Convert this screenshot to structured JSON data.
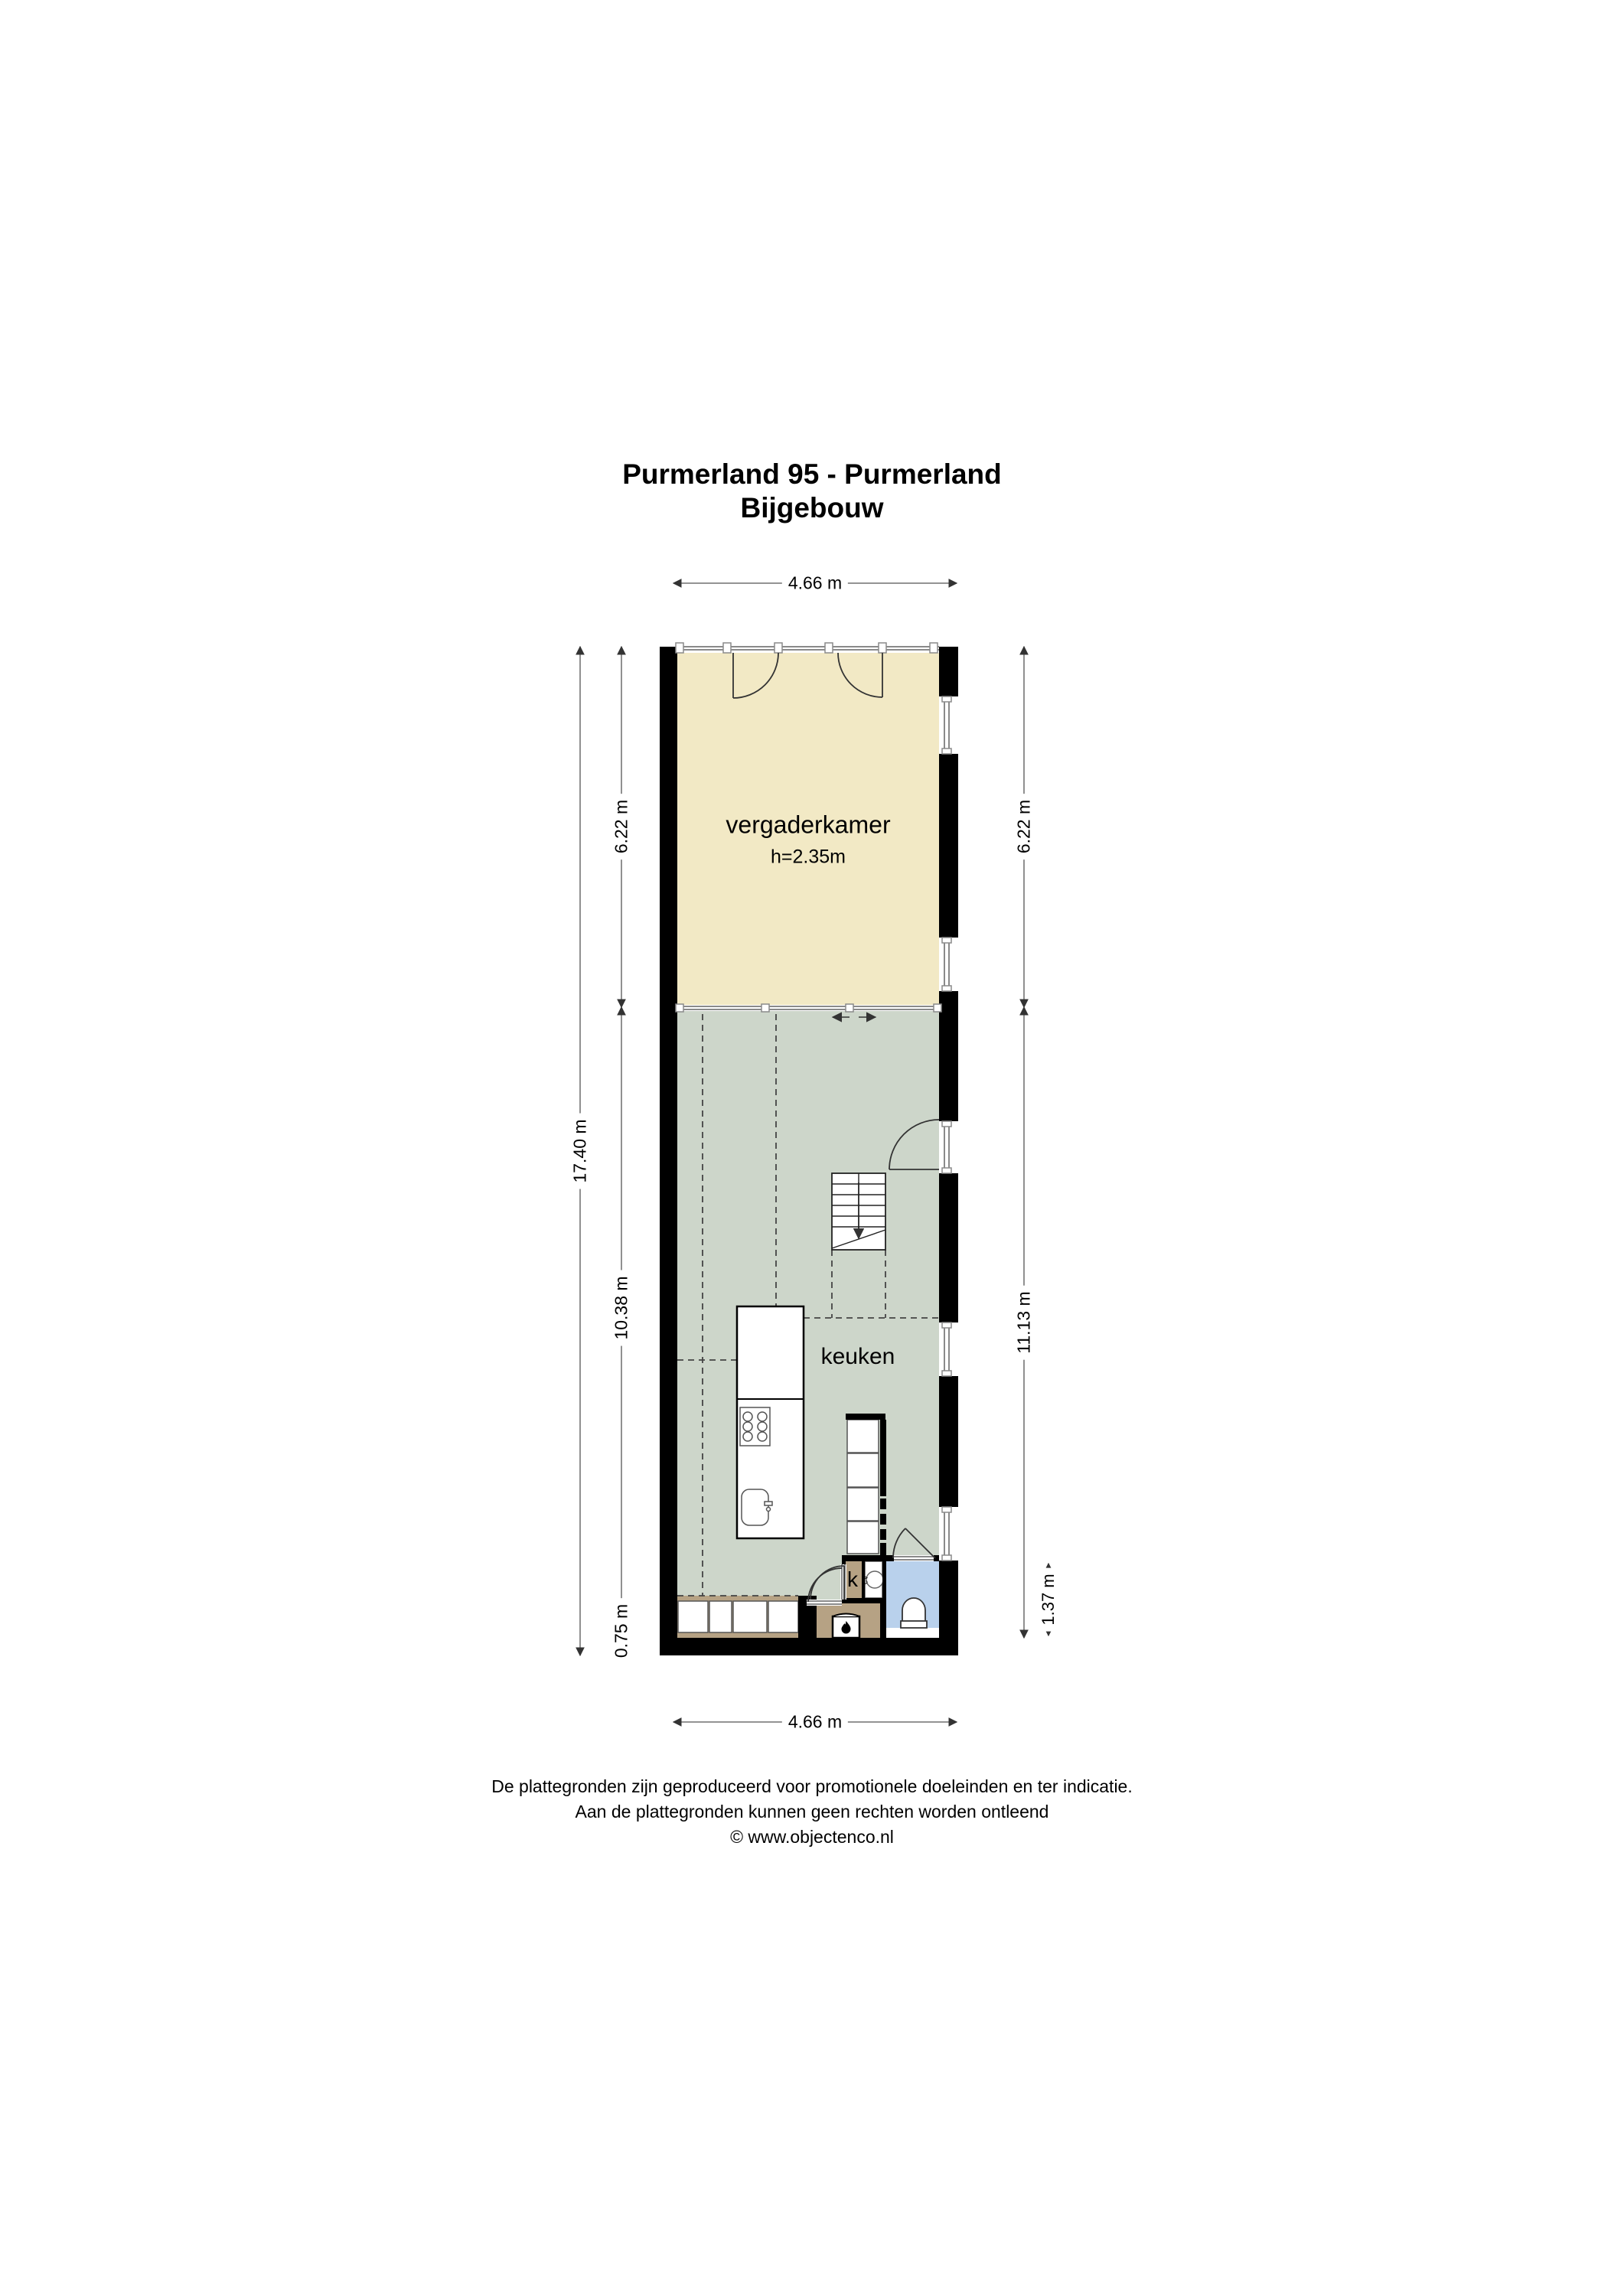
{
  "title": {
    "line1": "Purmerland 95 - Purmerland",
    "line2": "Bijgebouw"
  },
  "rooms": {
    "meeting_room": {
      "label": "vergaderkamer",
      "height_note": "h=2.35m"
    },
    "kitchen": {
      "label": "keuken"
    },
    "closet": {
      "label": "k"
    },
    "boiler": {
      "label": "cv"
    }
  },
  "dimensions": {
    "top_width": "4.66 m",
    "bottom_width": "4.66 m",
    "left_total_height": "17.40 m",
    "left_top": "6.22 m",
    "left_middle": "10.38 m",
    "left_bottom": "0.75 m",
    "right_top": "6.22 m",
    "right_middle": "11.13 m",
    "right_bottom": "1.37 m"
  },
  "footer": {
    "line1": "De plattegronden zijn geproduceerd voor promotionele doeleinden en ter indicatie.",
    "line2": "Aan de plattegronden kunnen geen rechten worden ontleend",
    "line3": "© www.objectenco.nl"
  },
  "colors": {
    "meeting_room_fill": "#f2e9c5",
    "kitchen_fill": "#cdd6ca",
    "toilet_fill": "#b9d1ec",
    "wood_fill": "#b6a284",
    "wall": "#000000"
  }
}
